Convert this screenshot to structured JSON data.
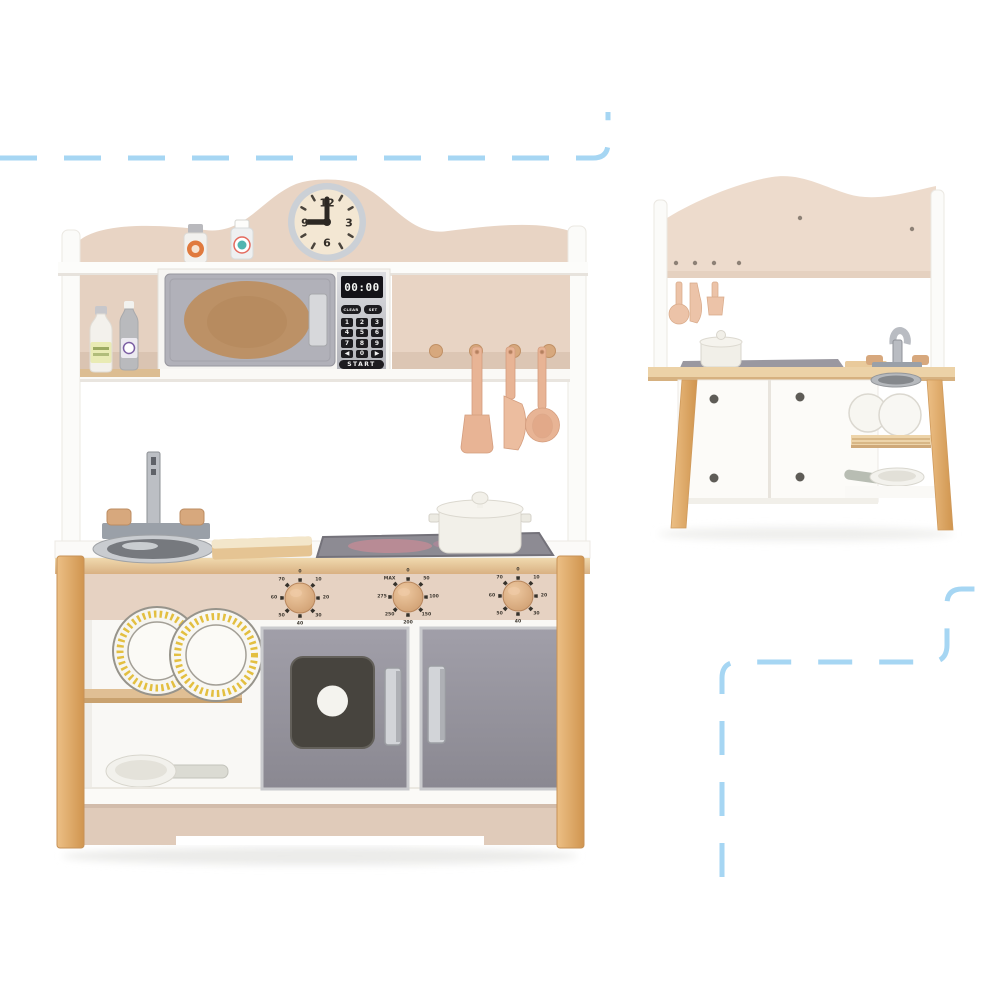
{
  "scene": {
    "subject": "Wooden toy kitchen playset product photo",
    "views": [
      "front view",
      "rear view"
    ]
  },
  "front_view": {
    "clock": {
      "twelve": "12",
      "three": "3",
      "six": "6",
      "nine": "9",
      "time_shown": "9:00"
    },
    "microwave": {
      "display": "00:00",
      "clear_button": "CLEAR",
      "set_button": "SET",
      "keypad": [
        "1",
        "2",
        "3",
        "4",
        "5",
        "6",
        "7",
        "8",
        "9",
        "◀",
        "0",
        "▶"
      ],
      "start_button": "START"
    },
    "stove_knobs": {
      "left": [
        "0",
        "10",
        "20",
        "30",
        "40",
        "50",
        "60",
        "70"
      ],
      "middle": [
        "0",
        "50",
        "100",
        "150",
        "200",
        "250",
        "275",
        "MAX"
      ],
      "right": [
        "0",
        "10",
        "20",
        "30",
        "40",
        "50",
        "60",
        "70"
      ]
    }
  },
  "colors": {
    "dash_blue": "#a6d6f3",
    "beige_panel": "#e8d4c4",
    "beige_rear": "#eddbcc",
    "plinth": "#e0cbba",
    "wood": "#dfa968",
    "wood_light": "#ecd2a7",
    "door_gray": "#94929c",
    "microwave_gray": "#b1b1b9",
    "silver": "#c9cbd0",
    "window_dark": "#47443e",
    "knob_tan": "#d7a87d",
    "utensil_tan": "#e8b495",
    "plate_rim_yellow": "#e3bf40",
    "steel": "#9aa0a8"
  }
}
